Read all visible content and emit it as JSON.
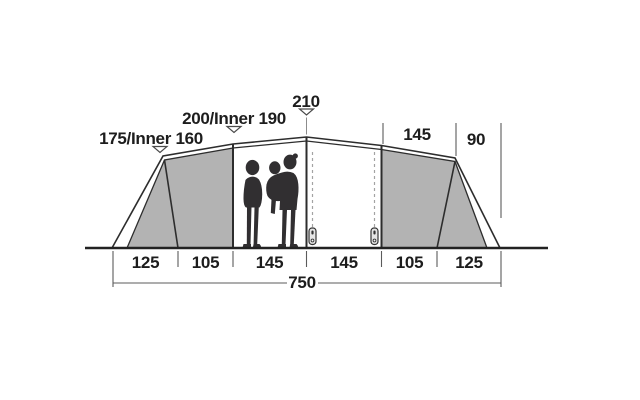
{
  "diagram": {
    "heights": [
      {
        "label": "175/Inner 160"
      },
      {
        "label": "200/Inner 190"
      },
      {
        "label": "210"
      }
    ],
    "top_widths": [
      "145",
      "90"
    ],
    "floor_widths": [
      "125",
      "105",
      "145",
      "145",
      "105",
      "125"
    ],
    "total_width": "750",
    "icons": {
      "height_marker": "triangle-down-icon",
      "door_zip": "zipper-pull-icon",
      "occupants": "people-silhouette-icon"
    },
    "colors": {
      "panel_gray": "#b3b3b3",
      "outline": "#2d2d2d",
      "dimension": "#5b5b5b",
      "text": "#1d1d1d",
      "silhouette": "#312f31",
      "background": "#ffffff"
    }
  }
}
